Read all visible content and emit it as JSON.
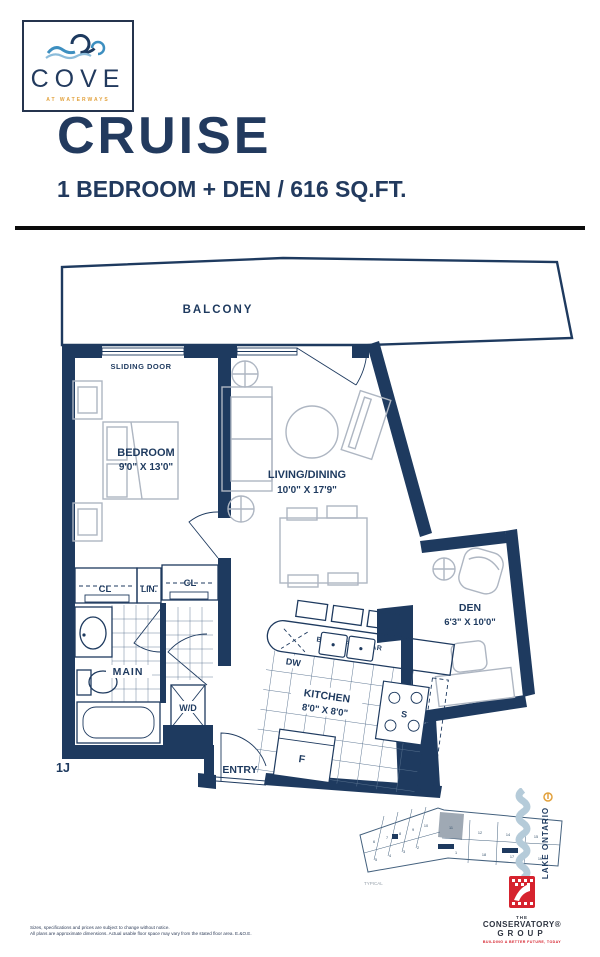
{
  "header": {
    "logo": {
      "brand": "COVE",
      "tagline": "AT WATERWAYS"
    },
    "plan_name": "CRUISE",
    "plan_spec": "1 BEDROOM + DEN / 616 SQ.FT."
  },
  "floorplan": {
    "unit_label": "1J",
    "balcony_label": "BALCONY",
    "sliding_door_label": "SLIDING DOOR",
    "rooms": {
      "bedroom": {
        "name": "BEDROOM",
        "dims": "9'0\" X 13'0\""
      },
      "living_dining": {
        "name": "LIVING/DINING",
        "dims": "10'0\" X 17'9\""
      },
      "den": {
        "name": "DEN",
        "dims": "6'3\" X 10'0\""
      },
      "kitchen": {
        "name": "KITCHEN",
        "dims": "8'0\" X 8'0\""
      }
    },
    "features": {
      "breakfast_bar": "BREAKFAST BAR",
      "dishwasher": "DW",
      "stove": "S",
      "fridge": "F",
      "washer_dryer": "W/D",
      "main_bath": "MAIN",
      "closet": "CL",
      "linen": "LIN.",
      "closet2": "CL",
      "entry": "ENTRY"
    }
  },
  "keyplan": {
    "caption": "TYPICAL",
    "water_label": "LAKE ONTARIO",
    "highlighted_unit": "11",
    "units_top": [
      "6",
      "7",
      "8",
      "9",
      "10",
      "11",
      "12",
      "14",
      "15"
    ],
    "units_bottom": [
      "5",
      "4",
      "3",
      "2",
      "1",
      "18",
      "17",
      "16"
    ]
  },
  "footer": {
    "builder": {
      "pre": "THE",
      "name": "CONSERVATORY®",
      "suffix": "GROUP",
      "tagline": "BUILDING A BETTER FUTURE, TODAY"
    },
    "disclaimer_line1": "Sizes, specifications and prices are subject to change without notice.",
    "disclaimer_line2": "All plans are approximate dimensions. Actual usable floor space may vary from the stated floor area. E.&O.E."
  },
  "colors": {
    "navy": "#1e3a5f",
    "orange": "#e2a13c",
    "red": "#d6232e",
    "water": "#b5cbd9",
    "rule": "#0b0b0b"
  }
}
